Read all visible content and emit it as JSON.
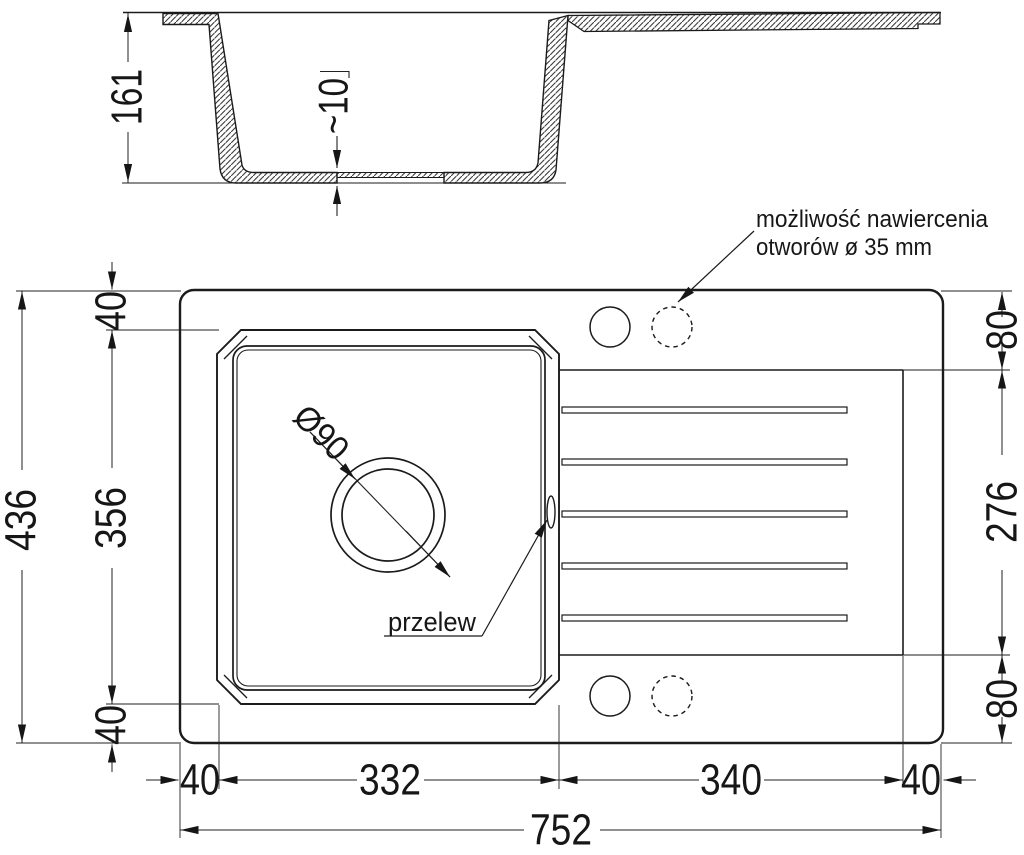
{
  "section": {
    "height": "161",
    "drain_thickness": "~10"
  },
  "plan": {
    "overall_height": "436",
    "overall_width": "752",
    "margin_top": "40",
    "bowl_height": "356",
    "margin_bottom": "40",
    "right_margin_top": "80",
    "drainer_span": "276",
    "right_margin_bottom": "80",
    "margin_left": "40",
    "bowl_width": "332",
    "drainer_width": "340",
    "margin_right": "40",
    "drain_diameter": "Ø90",
    "overflow_label": "przelew",
    "note_line1": "możliwość nawiercenia",
    "note_line2": "otworów ø 35 mm"
  },
  "colors": {
    "line": "#1b1b1b",
    "dimension": "#222222",
    "background": "#ffffff"
  }
}
